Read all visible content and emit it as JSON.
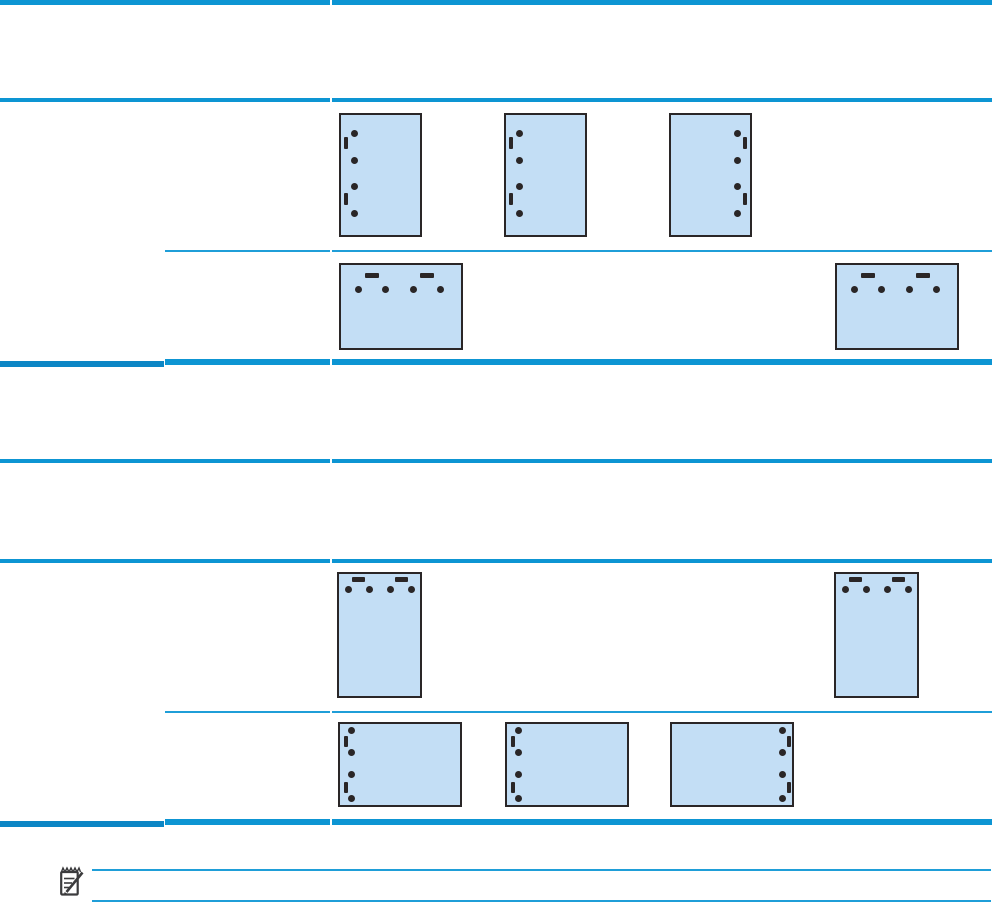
{
  "document": {
    "kind": "printer-manual-table-page",
    "visible_text": "",
    "width": 992,
    "height": 903
  },
  "colors": {
    "page_background": "#ffffff",
    "rule_blue": "#0d95d3",
    "rule_blue_dark": "#0c86c5",
    "rule_blue_thin": "#1f9ed8",
    "diagram_fill": "#c3def5",
    "diagram_border": "#2a2627",
    "mark_color": "#2a2627",
    "note_icon_color": "#3b3b3d"
  },
  "table_rules": [
    {
      "id": "table1-top-border",
      "y": 0,
      "h": 4.5,
      "color": "#0d95d3",
      "segments": [
        [
          0,
          330
        ],
        [
          332,
          992
        ]
      ]
    },
    {
      "id": "table1-header-row-border",
      "y": 98,
      "h": 4,
      "color": "#0d95d3",
      "segments": [
        [
          0,
          330
        ],
        [
          332,
          992
        ]
      ]
    },
    {
      "id": "table1-subrow-divider",
      "y": 249.5,
      "h": 2,
      "color": "#1f9ed8",
      "segments": [
        [
          165,
          330
        ],
        [
          332,
          992
        ]
      ]
    },
    {
      "id": "table1-bottom-border-left",
      "y": 360.5,
      "h": 6,
      "color": "#0c86c5",
      "segments": [
        [
          0,
          163.5
        ]
      ]
    },
    {
      "id": "table1-bottom-border-right",
      "y": 359,
      "h": 6,
      "color": "#0d95d3",
      "segments": [
        [
          165,
          329.5
        ],
        [
          331.5,
          992
        ]
      ]
    },
    {
      "id": "table2-top-border",
      "y": 459,
      "h": 4,
      "color": "#0d95d3",
      "segments": [
        [
          0,
          330
        ],
        [
          332,
          992
        ]
      ]
    },
    {
      "id": "table2-header-row-border",
      "y": 559,
      "h": 3.5,
      "color": "#0d95d3",
      "segments": [
        [
          0,
          330
        ],
        [
          332,
          992
        ]
      ]
    },
    {
      "id": "table2-subrow-divider",
      "y": 711,
      "h": 2,
      "color": "#1f9ed8",
      "segments": [
        [
          165,
          330
        ],
        [
          332,
          992
        ]
      ]
    },
    {
      "id": "table2-bottom-border-left",
      "y": 820.5,
      "h": 6,
      "color": "#0c86c5",
      "segments": [
        [
          0,
          163.5
        ]
      ]
    },
    {
      "id": "table2-bottom-border-right",
      "y": 819,
      "h": 6,
      "color": "#0d95d3",
      "segments": [
        [
          165,
          329.5
        ],
        [
          331.5,
          992
        ]
      ]
    },
    {
      "id": "note-top-border",
      "y": 869,
      "h": 2,
      "color": "#1f9ed8",
      "segments": [
        [
          92,
          991
        ]
      ]
    },
    {
      "id": "note-bottom-border",
      "y": 900,
      "h": 2,
      "color": "#1f9ed8",
      "segments": [
        [
          92,
          991
        ]
      ]
    }
  ],
  "diagram_style": {
    "dot_diameter": 7,
    "border_width": 2
  },
  "diagrams": [
    {
      "name": "portrait-page-punch-left-1",
      "x": 339,
      "y": 113,
      "w": 83,
      "h": 124,
      "dots": [
        [
          15,
          20
        ],
        [
          15,
          47
        ],
        [
          15,
          73
        ],
        [
          15,
          100
        ]
      ],
      "bars": [
        [
          5,
          24,
          4,
          12
        ],
        [
          5,
          80,
          4,
          12
        ]
      ]
    },
    {
      "name": "portrait-page-punch-left-2",
      "x": 504,
      "y": 113,
      "w": 83,
      "h": 124,
      "dots": [
        [
          15,
          20
        ],
        [
          15,
          47
        ],
        [
          15,
          73
        ],
        [
          15,
          100
        ]
      ],
      "bars": [
        [
          5,
          24,
          4,
          12
        ],
        [
          5,
          80,
          4,
          12
        ]
      ]
    },
    {
      "name": "portrait-page-punch-right",
      "x": 669,
      "y": 113,
      "w": 83,
      "h": 124,
      "dots": [
        [
          68,
          20
        ],
        [
          68,
          47
        ],
        [
          68,
          73
        ],
        [
          68,
          100
        ]
      ],
      "bars": [
        [
          74,
          24,
          4,
          12
        ],
        [
          74,
          80,
          4,
          12
        ]
      ]
    },
    {
      "name": "landscape-page-punch-top-1",
      "x": 339,
      "y": 263,
      "w": 124,
      "h": 87,
      "dots": [
        [
          19,
          26
        ],
        [
          46,
          26
        ],
        [
          74,
          26
        ],
        [
          101,
          26
        ]
      ],
      "bars": [
        [
          26,
          10,
          14,
          5
        ],
        [
          81,
          10,
          14,
          5
        ]
      ]
    },
    {
      "name": "landscape-page-punch-top-2",
      "x": 835,
      "y": 263,
      "w": 124,
      "h": 87,
      "dots": [
        [
          19,
          26
        ],
        [
          46,
          26
        ],
        [
          74,
          26
        ],
        [
          101,
          26
        ]
      ],
      "bars": [
        [
          26,
          10,
          14,
          5
        ],
        [
          81,
          10,
          14,
          5
        ]
      ]
    },
    {
      "name": "portrait-page-punch-top-1",
      "x": 337,
      "y": 572,
      "w": 85,
      "h": 126,
      "dots": [
        [
          11.5,
          17
        ],
        [
          32.5,
          17
        ],
        [
          53.5,
          17
        ],
        [
          74,
          17
        ]
      ],
      "bars": [
        [
          15,
          5,
          13,
          4.5
        ],
        [
          57.5,
          5,
          13,
          4.5
        ]
      ]
    },
    {
      "name": "portrait-page-punch-top-2",
      "x": 834,
      "y": 572,
      "w": 85,
      "h": 126,
      "dots": [
        [
          11.5,
          17
        ],
        [
          32.5,
          17
        ],
        [
          53.5,
          17
        ],
        [
          74,
          17
        ]
      ],
      "bars": [
        [
          15,
          5,
          13,
          4.5
        ],
        [
          57.5,
          5,
          13,
          4.5
        ]
      ]
    },
    {
      "name": "landscape-page-punch-left-1",
      "x": 338,
      "y": 722,
      "w": 124,
      "h": 85,
      "dots": [
        [
          13,
          8
        ],
        [
          13,
          30
        ],
        [
          13,
          52
        ],
        [
          13,
          76
        ]
      ],
      "bars": [
        [
          5.5,
          14,
          4,
          11
        ],
        [
          5.5,
          60,
          4,
          11
        ]
      ]
    },
    {
      "name": "landscape-page-punch-left-2",
      "x": 505,
      "y": 722,
      "w": 124,
      "h": 85,
      "dots": [
        [
          13,
          8
        ],
        [
          13,
          30
        ],
        [
          13,
          52
        ],
        [
          13,
          76
        ]
      ],
      "bars": [
        [
          5.5,
          14,
          4,
          11
        ],
        [
          5.5,
          60,
          4,
          11
        ]
      ]
    },
    {
      "name": "landscape-page-punch-right",
      "x": 670,
      "y": 722,
      "w": 124,
      "h": 85,
      "dots": [
        [
          112,
          8
        ],
        [
          112,
          30
        ],
        [
          112,
          52
        ],
        [
          112,
          76
        ]
      ],
      "bars": [
        [
          117,
          14,
          4,
          11
        ],
        [
          117,
          60,
          4,
          11
        ]
      ]
    }
  ],
  "note": {
    "icon": "note-icon"
  }
}
